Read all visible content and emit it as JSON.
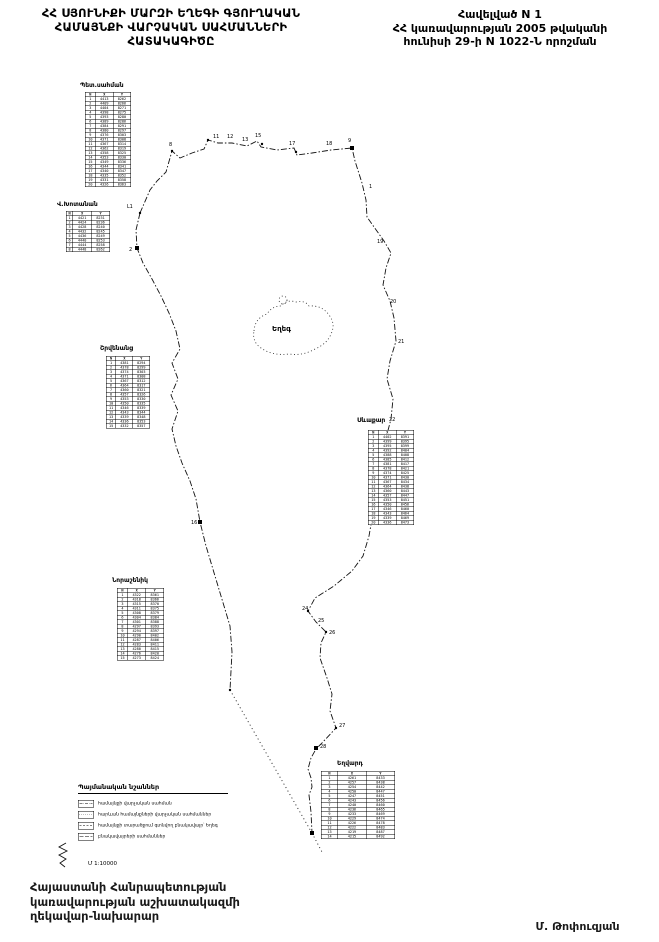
{
  "header": {
    "title_lines": [
      "ՀՀ ՍՅՈՒՆԻՔԻ ՄԱՐԶԻ ԵՂԵԳԻ ԳՅՈՒՂԱԿԱՆ",
      "ՀԱՄԱՅՆՔԻ  ՎԱՐՉԱԿԱՆ  ՍԱՀՄԱՆՆԵՐԻ",
      "ՀԱՏԱԿԱԳԻԾԸ"
    ],
    "annex_lines": [
      "Հավելված N 1",
      "ՀՀ կառավարության 2005 թվականի",
      "հունիսի 29-ի N 1022-Ն որոշման"
    ]
  },
  "map": {
    "village_label": "Եղեգ",
    "tables": [
      {
        "id": "pet-sahman",
        "label": "Պետ.սահման",
        "label_x": 80,
        "label_y": 82,
        "x": 85,
        "y": 92,
        "w": 92,
        "headers": [
          "N",
          "X",
          "Y"
        ],
        "rows": [
          [
            "1",
            "4413",
            "8262"
          ],
          [
            "2",
            "4409",
            "8266"
          ],
          [
            "3",
            "4404",
            "8271"
          ],
          [
            "4",
            "4398",
            "8275"
          ],
          [
            "5",
            "4393",
            "8280"
          ],
          [
            "6",
            "4389",
            "8286"
          ],
          [
            "7",
            "4384",
            "8291"
          ],
          [
            "8",
            "4380",
            "8297"
          ],
          [
            "9",
            "4376",
            "8303"
          ],
          [
            "10",
            "4371",
            "8308"
          ],
          [
            "11",
            "4367",
            "8314"
          ],
          [
            "12",
            "4362",
            "8319"
          ],
          [
            "13",
            "4358",
            "8325"
          ],
          [
            "14",
            "4353",
            "8330"
          ],
          [
            "15",
            "4349",
            "8336"
          ],
          [
            "16",
            "4344",
            "8341"
          ],
          [
            "17",
            "4340",
            "8347"
          ],
          [
            "18",
            "4335",
            "8352"
          ],
          [
            "19",
            "4331",
            "8358"
          ],
          [
            "20",
            "4326",
            "8363"
          ]
        ]
      },
      {
        "id": "v-khotanan",
        "label": "Վ.Խոտանան",
        "label_x": 57,
        "label_y": 201,
        "x": 66,
        "y": 211,
        "w": 88,
        "headers": [
          "N",
          "X",
          "Y"
        ],
        "rows": [
          [
            "1",
            "4421",
            "8231"
          ],
          [
            "2",
            "4424",
            "8236"
          ],
          [
            "3",
            "4428",
            "8240"
          ],
          [
            "4",
            "4432",
            "8245"
          ],
          [
            "5",
            "4436",
            "8249"
          ],
          [
            "6",
            "4440",
            "8253"
          ],
          [
            "7",
            "4444",
            "8258"
          ],
          [
            "8",
            "4448",
            "8262"
          ]
        ]
      },
      {
        "id": "shrvenants",
        "label": "Շրվենանց",
        "label_x": 100,
        "label_y": 345,
        "x": 106,
        "y": 356,
        "w": 88,
        "headers": [
          "N",
          "X",
          "Y"
        ],
        "rows": [
          [
            "1",
            "4381",
            "8294"
          ],
          [
            "2",
            "4378",
            "8299"
          ],
          [
            "3",
            "4374",
            "8303"
          ],
          [
            "4",
            "4371",
            "8308"
          ],
          [
            "5",
            "4367",
            "8312"
          ],
          [
            "6",
            "4364",
            "8317"
          ],
          [
            "7",
            "4360",
            "8321"
          ],
          [
            "8",
            "4357",
            "8326"
          ],
          [
            "9",
            "4353",
            "8330"
          ],
          [
            "10",
            "4350",
            "8335"
          ],
          [
            "11",
            "4346",
            "8339"
          ],
          [
            "12",
            "4343",
            "8344"
          ],
          [
            "13",
            "4339",
            "8348"
          ],
          [
            "14",
            "4336",
            "8353"
          ],
          [
            "15",
            "4332",
            "8357"
          ]
        ]
      },
      {
        "id": "sevakar",
        "label": "Սևաքար",
        "label_x": 357,
        "label_y": 417,
        "x": 368,
        "y": 430,
        "w": 92,
        "headers": [
          "N",
          "X",
          "Y"
        ],
        "rows": [
          [
            "1",
            "4402",
            "8391"
          ],
          [
            "2",
            "4399",
            "8395"
          ],
          [
            "3",
            "4395",
            "8399"
          ],
          [
            "4",
            "4392",
            "8404"
          ],
          [
            "5",
            "4388",
            "8408"
          ],
          [
            "6",
            "4385",
            "8412"
          ],
          [
            "7",
            "4381",
            "8417"
          ],
          [
            "8",
            "4378",
            "8421"
          ],
          [
            "9",
            "4374",
            "8425"
          ],
          [
            "10",
            "4371",
            "8430"
          ],
          [
            "11",
            "4367",
            "8434"
          ],
          [
            "12",
            "4364",
            "8438"
          ],
          [
            "13",
            "4360",
            "8443"
          ],
          [
            "14",
            "4357",
            "8447"
          ],
          [
            "15",
            "4353",
            "8451"
          ],
          [
            "16",
            "4350",
            "8456"
          ],
          [
            "17",
            "4346",
            "8460"
          ],
          [
            "18",
            "4343",
            "8464"
          ],
          [
            "19",
            "4339",
            "8469"
          ],
          [
            "20",
            "4336",
            "8473"
          ]
        ]
      },
      {
        "id": "norashenik",
        "label": "Նորաշենիկ",
        "label_x": 112,
        "label_y": 577,
        "x": 117,
        "y": 588,
        "w": 94,
        "headers": [
          "N",
          "X",
          "Y"
        ],
        "rows": [
          [
            "1",
            "4322",
            "8361"
          ],
          [
            "2",
            "4318",
            "8366"
          ],
          [
            "3",
            "4315",
            "8370"
          ],
          [
            "4",
            "4311",
            "8375"
          ],
          [
            "5",
            "4308",
            "8379"
          ],
          [
            "6",
            "4304",
            "8384"
          ],
          [
            "7",
            "4301",
            "8388"
          ],
          [
            "8",
            "4297",
            "8393"
          ],
          [
            "9",
            "4294",
            "8397"
          ],
          [
            "10",
            "4290",
            "8402"
          ],
          [
            "11",
            "4287",
            "8406"
          ],
          [
            "12",
            "4283",
            "8411"
          ],
          [
            "13",
            "4280",
            "8415"
          ],
          [
            "14",
            "4276",
            "8420"
          ],
          [
            "15",
            "4273",
            "8424"
          ]
        ]
      },
      {
        "id": "yeghvard",
        "label": "Եղվարդ",
        "label_x": 337,
        "label_y": 760,
        "x": 321,
        "y": 771,
        "w": 148,
        "headers": [
          "N",
          "X",
          "Y"
        ],
        "rows": [
          [
            "1",
            "4261",
            "8433"
          ],
          [
            "2",
            "4257",
            "8438"
          ],
          [
            "3",
            "4254",
            "8442"
          ],
          [
            "4",
            "4250",
            "8447"
          ],
          [
            "5",
            "4247",
            "8451"
          ],
          [
            "6",
            "4243",
            "8456"
          ],
          [
            "7",
            "4240",
            "8460"
          ],
          [
            "8",
            "4236",
            "8465"
          ],
          [
            "9",
            "4233",
            "8469"
          ],
          [
            "10",
            "4229",
            "8474"
          ],
          [
            "11",
            "4226",
            "8478"
          ],
          [
            "12",
            "4222",
            "8483"
          ],
          [
            "13",
            "4219",
            "8487"
          ],
          [
            "14",
            "4215",
            "8492"
          ]
        ]
      }
    ],
    "points": [
      {
        "label": "Լ1",
        "x": 127,
        "y": 208
      },
      {
        "label": "2",
        "x": 129,
        "y": 251
      },
      {
        "label": "8",
        "x": 169,
        "y": 146
      },
      {
        "label": "11",
        "x": 213,
        "y": 138
      },
      {
        "label": "12",
        "x": 227,
        "y": 138
      },
      {
        "label": "13",
        "x": 242,
        "y": 141
      },
      {
        "label": "15",
        "x": 255,
        "y": 137
      },
      {
        "label": "17",
        "x": 289,
        "y": 145
      },
      {
        "label": "18",
        "x": 326,
        "y": 145
      },
      {
        "label": "9",
        "x": 348,
        "y": 142
      },
      {
        "label": "1",
        "x": 369,
        "y": 188
      },
      {
        "label": "19",
        "x": 377,
        "y": 243
      },
      {
        "label": "20",
        "x": 390,
        "y": 303
      },
      {
        "label": "21",
        "x": 398,
        "y": 343
      },
      {
        "label": "22",
        "x": 389,
        "y": 421
      },
      {
        "label": "23",
        "x": 376,
        "y": 493
      },
      {
        "label": "16",
        "x": 191,
        "y": 524
      },
      {
        "label": "24",
        "x": 302,
        "y": 610
      },
      {
        "label": "25",
        "x": 318,
        "y": 622
      },
      {
        "label": "26",
        "x": 329,
        "y": 634
      },
      {
        "label": "27",
        "x": 339,
        "y": 727
      },
      {
        "label": "28",
        "x": 320,
        "y": 748
      }
    ],
    "markers": [
      {
        "x": 352,
        "y": 148,
        "shape": "square"
      },
      {
        "x": 137,
        "y": 248,
        "shape": "square"
      },
      {
        "x": 200,
        "y": 522,
        "shape": "square"
      },
      {
        "x": 316,
        "y": 748,
        "shape": "square"
      },
      {
        "x": 312,
        "y": 833,
        "shape": "square"
      },
      {
        "x": 140,
        "y": 213,
        "shape": "dot"
      },
      {
        "x": 172,
        "y": 151,
        "shape": "dot"
      },
      {
        "x": 208,
        "y": 140,
        "shape": "dot"
      },
      {
        "x": 262,
        "y": 144,
        "shape": "dot"
      },
      {
        "x": 296,
        "y": 152,
        "shape": "dot"
      },
      {
        "x": 308,
        "y": 611,
        "shape": "dot"
      },
      {
        "x": 326,
        "y": 632,
        "shape": "dot"
      },
      {
        "x": 336,
        "y": 728,
        "shape": "dot"
      },
      {
        "x": 230,
        "y": 690,
        "shape": "dot"
      }
    ]
  },
  "legend": {
    "title": "Պայմանական նշաններ",
    "items": [
      {
        "symbol": "dashdot",
        "label": "համայնքի վարչական սահման"
      },
      {
        "symbol": "dots",
        "label": "հարևան համայնքների վարչական սահմաններ"
      },
      {
        "symbol": "dash",
        "label": "համայնքի տարածքում գտնվող բնակավայր՝ Եղեգ"
      },
      {
        "symbol": "longdash",
        "label": "բնակավայրերի սահմաններ"
      }
    ]
  },
  "scale_label": "Մ 1:10000",
  "footer": {
    "left_lines": [
      "Հայաստանի Հանրապետության",
      "կառավարության աշխատակազմի",
      "ղեկավար-նախարար"
    ],
    "signature": "Մ. Թոփուզյան"
  }
}
